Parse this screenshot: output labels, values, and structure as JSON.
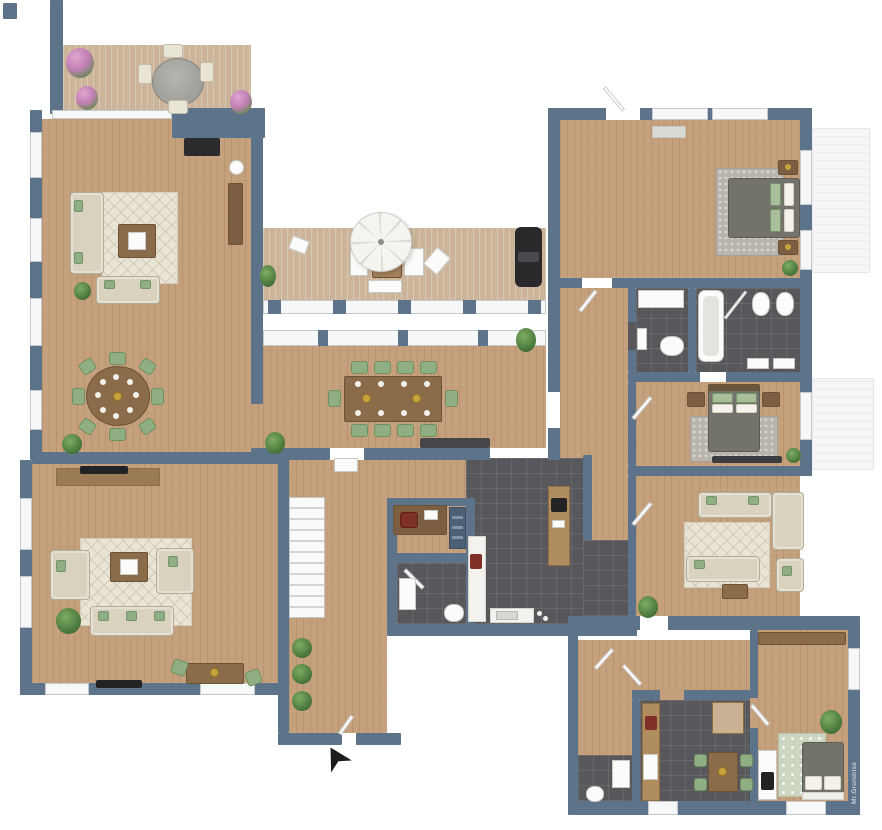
{
  "watermark": {
    "text": "Mr.Grundriss"
  },
  "palette": {
    "wall": "#5d7389",
    "floor-wood": "#c5a07c",
    "floor-deck": "#cbb499",
    "floor-tile": "#58585c",
    "rug-cream": "#eae4d4",
    "rug-gray": "#b9b5ac",
    "rug-green": "#ccd6c0",
    "sofa": "#d9d2bf",
    "sofa-border": "#b3ac96",
    "green": "#8fae83",
    "wood-dark": "#8a6c4a",
    "bed": "#73736b",
    "window": "#f6f7f8",
    "counter-blue": "#4c6175",
    "black": "#232326",
    "gold": "#c8a23c",
    "accent-red": "#7e3026"
  },
  "compass": {
    "symbol": "arrow-up-left",
    "meaning": "entrance-arrow"
  },
  "rooms": [
    {
      "id": "terrace",
      "floor": "deck",
      "furniture": [
        "round table",
        "4 chairs",
        "flowering potted plants"
      ]
    },
    {
      "id": "living-room-upper",
      "floor": "wood",
      "furniture": [
        "sofa",
        "loveseat",
        "coffee table",
        "area rug",
        "fireplace",
        "side table",
        "tall cabinet",
        "plants"
      ]
    },
    {
      "id": "dining-area-left",
      "floor": "wood",
      "furniture": [
        "round dining table",
        "8 green chairs",
        "plants"
      ]
    },
    {
      "id": "balcony",
      "floor": "deck",
      "furniture": [
        "parasol",
        "lounge set",
        "barbecue grill",
        "potted plant",
        "railing"
      ]
    },
    {
      "id": "great-dining-room",
      "floor": "wood",
      "furniture": [
        "long dining table",
        "10 green chairs",
        "dark sideboard",
        "plant"
      ]
    },
    {
      "id": "bedroom-1",
      "floor": "wood",
      "furniture": [
        "double bed",
        "2 nightstands",
        "shag rug",
        "window bench",
        "plant"
      ]
    },
    {
      "id": "bathroom-1",
      "floor": "tile",
      "furniture": [
        "shower",
        "toilet",
        "washbasin"
      ]
    },
    {
      "id": "bathroom-2",
      "floor": "tile",
      "furniture": [
        "bathtub",
        "2 wall toilets",
        "2 washbasins",
        "glass screen"
      ]
    },
    {
      "id": "bedroom-2",
      "floor": "wood",
      "furniture": [
        "double bed",
        "2 nightstands",
        "rug",
        "low dresser",
        "plant"
      ]
    },
    {
      "id": "living-room-right",
      "floor": "wood",
      "furniture": [
        "sectional sofa",
        "armchair",
        "coffee table",
        "rug",
        "plant"
      ]
    },
    {
      "id": "kitchen",
      "floor": "tile",
      "furniture": [
        "peninsula counter",
        "cooktop",
        "sink counter",
        "side counter",
        "espresso machine"
      ]
    },
    {
      "id": "office-nook",
      "floor": "wood",
      "furniture": [
        "desk",
        "chair",
        "laptop",
        "blue drawer cabinet"
      ]
    },
    {
      "id": "wc",
      "floor": "tile",
      "furniture": [
        "toilet",
        "shower tray"
      ]
    },
    {
      "id": "hallway",
      "floor": "wood",
      "furniture": [
        "staircase",
        "3 plants",
        "console",
        "entrance door"
      ]
    },
    {
      "id": "living-room-lower-left",
      "floor": "wood",
      "furniture": [
        "sofa",
        "2 armchairs",
        "coffee table",
        "rug",
        "game table",
        "2 green chairs",
        "TV sideboard",
        "plant"
      ]
    },
    {
      "id": "unit-hallway",
      "floor": "wood",
      "furniture": [
        "doors"
      ]
    },
    {
      "id": "unit-bathroom",
      "floor": "tile",
      "furniture": [
        "toilet",
        "vanity"
      ]
    },
    {
      "id": "unit-kitchen",
      "floor": "tile",
      "furniture": [
        "counter",
        "sink",
        "table",
        "4 green chairs",
        "cabinet",
        "espresso machine"
      ]
    },
    {
      "id": "bedroom-3",
      "floor": "wood",
      "furniture": [
        "bed",
        "wardrobe",
        "dresser",
        "tv",
        "dotted rug",
        "plant"
      ]
    }
  ]
}
